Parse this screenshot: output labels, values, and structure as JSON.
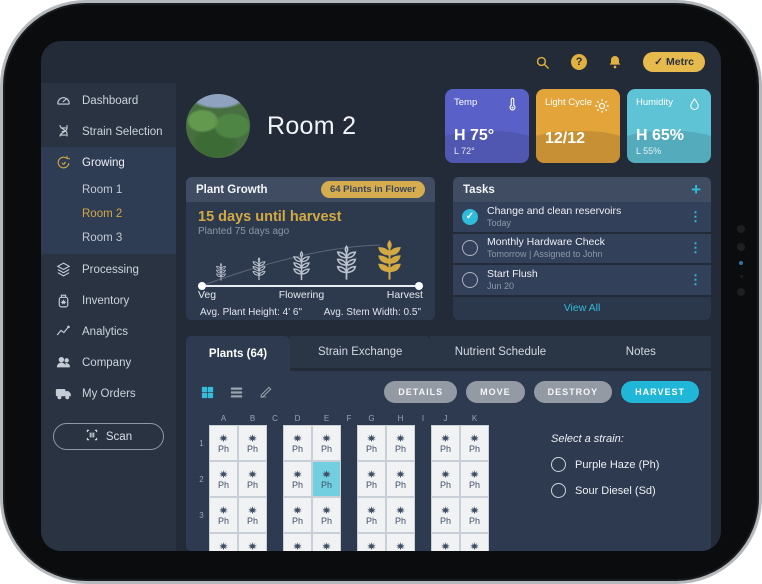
{
  "topbar": {
    "metrc_label": "Metrc",
    "icons": [
      "search-icon",
      "help-icon",
      "bell-icon"
    ]
  },
  "sidebar": {
    "items": [
      {
        "label": "Dashboard",
        "icon": "gauge"
      },
      {
        "label": "Strain Selection",
        "icon": "dna"
      },
      {
        "label": "Growing",
        "icon": "grow",
        "active": true,
        "children": [
          "Room 1",
          "Room 2",
          "Room 3"
        ],
        "active_child": "Room 2"
      },
      {
        "label": "Processing",
        "icon": "layers"
      },
      {
        "label": "Inventory",
        "icon": "jar"
      },
      {
        "label": "Analytics",
        "icon": "chart"
      },
      {
        "label": "Company",
        "icon": "people"
      },
      {
        "label": "My Orders",
        "icon": "truck"
      }
    ],
    "scan_label": "Scan"
  },
  "room": {
    "title": "Room 2"
  },
  "env_cards": [
    {
      "label": "Temp",
      "icon": "thermometer",
      "value": "H 75°",
      "sub": "L 72°",
      "color": "#5961c9"
    },
    {
      "label": "Light Cycle",
      "icon": "sun",
      "value": "12/12",
      "sub": "",
      "color": "#e3a43a"
    },
    {
      "label": "Humidity",
      "icon": "droplet",
      "value": "H 65%",
      "sub": "L 55%",
      "color": "#5ec3d5"
    }
  ],
  "plant_growth": {
    "title": "Plant Growth",
    "badge": "64 Plants in Flower",
    "headline": "15 days until harvest",
    "subline": "Planted 75 days ago",
    "stage_labels": [
      "Veg",
      "Flowering",
      "Harvest"
    ],
    "stats": [
      "Avg. Plant Height: 4' 6\"",
      "Avg. Stem Width: 0.5\""
    ]
  },
  "tasks": {
    "title": "Tasks",
    "add_label": "+",
    "items": [
      {
        "title": "Change and clean reservoirs",
        "meta": "Today",
        "done": true
      },
      {
        "title": "Monthly Hardware Check",
        "meta": "Tomorrow | Assigned to John",
        "done": false
      },
      {
        "title": "Start Flush",
        "meta": "Jun 20",
        "done": false
      }
    ],
    "view_all": "View All"
  },
  "tabs": [
    {
      "label": "Plants (64)",
      "active": true
    },
    {
      "label": "Strain Exchange",
      "active": false
    },
    {
      "label": "Nutrient Schedule",
      "active": false
    },
    {
      "label": "Notes",
      "active": false
    }
  ],
  "toolbar": {
    "view_icons": [
      "grid-view",
      "list-view",
      "pen"
    ],
    "buttons": [
      {
        "label": "DETAILS",
        "style": "gray"
      },
      {
        "label": "MOVE",
        "style": "gray"
      },
      {
        "label": "DESTROY",
        "style": "gray"
      },
      {
        "label": "HARVEST",
        "style": "teal"
      }
    ]
  },
  "grid": {
    "columns": [
      {
        "label": "A",
        "aisle": false
      },
      {
        "label": "B",
        "aisle": false
      },
      {
        "label": "C",
        "aisle": true
      },
      {
        "label": "D",
        "aisle": false
      },
      {
        "label": "E",
        "aisle": false
      },
      {
        "label": "F",
        "aisle": true
      },
      {
        "label": "G",
        "aisle": false
      },
      {
        "label": "H",
        "aisle": false
      },
      {
        "label": "I",
        "aisle": true
      },
      {
        "label": "J",
        "aisle": false
      },
      {
        "label": "K",
        "aisle": false
      }
    ],
    "rows": [
      "1",
      "2",
      "3"
    ],
    "partial_next_row": true,
    "cell_label": "Ph",
    "selected_cell": "E2"
  },
  "strain_selector": {
    "title": "Select a strain:",
    "options": [
      "Purple Haze (Ph)",
      "Sour Diesel (Sd)"
    ]
  },
  "colors": {
    "accent_gold": "#d2a943",
    "accent_teal": "#2fbbd9",
    "selected_cell": "#72cfdf",
    "temp_card": "#5961c9",
    "light_card": "#e3a43a",
    "humidity_card": "#5ec3d5"
  }
}
